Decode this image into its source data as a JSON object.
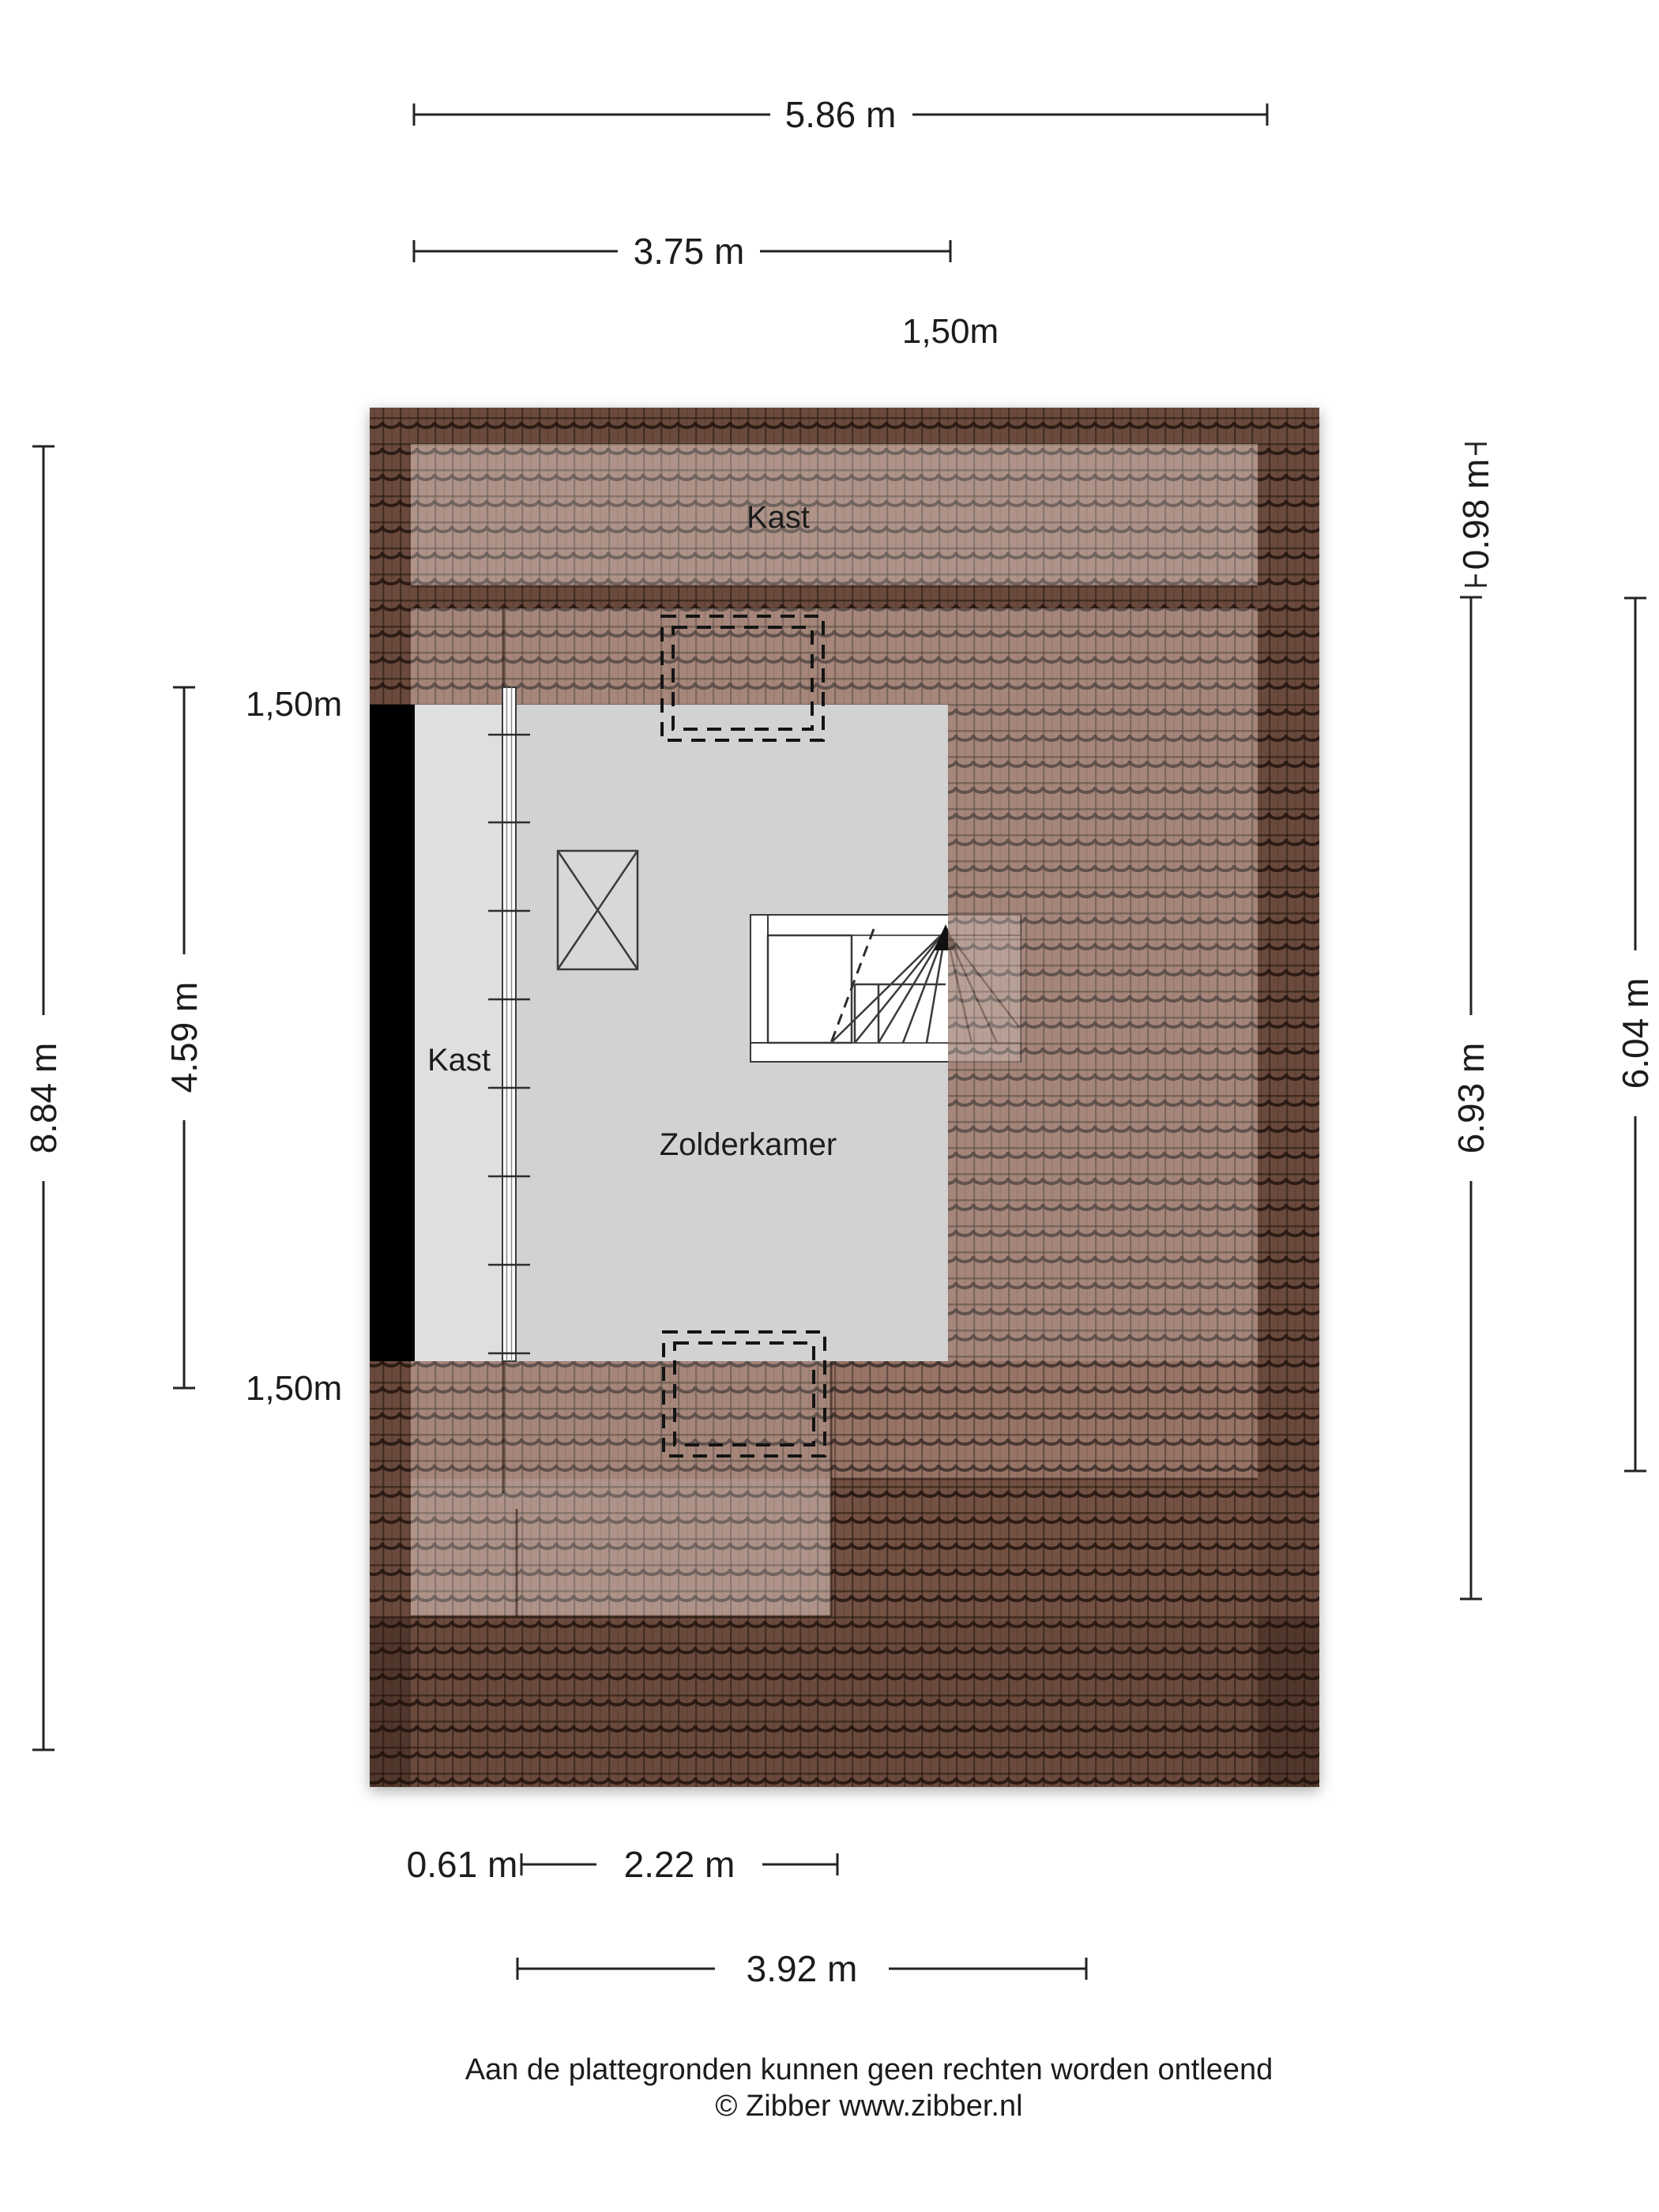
{
  "colors": {
    "roof_base": "#8d6555",
    "roof_seam": "#2f1f16",
    "room_gray": "#d2d2d2",
    "kast_gray": "#dfdfdf",
    "wall_black": "#000000",
    "stair_white": "#ffffff",
    "dim_line": "#232323"
  },
  "rooms": {
    "kast_top": "Kast",
    "kast_left": "Kast",
    "zolderkamer": "Zolderkamer"
  },
  "dimensions": {
    "top_total": "5.86 m",
    "top_room": "3.75 m",
    "top_right_offset": "1,50m",
    "left_total": "8.84 m",
    "left_room": "4.59 m",
    "left_top_offset": "1,50m",
    "left_bottom_offset": "1,50m",
    "right_eave": "0.98 m",
    "right_total": "6.93 m",
    "right_room": "6.04 m",
    "bottom_left_offset": "0.61 m",
    "bottom_inner": "2.22 m",
    "bottom_total": "3.92 m"
  },
  "footer": {
    "disclaimer": "Aan de plattegronden kunnen geen rechten worden ontleend",
    "copyright": "© Zibber www.zibber.nl"
  }
}
